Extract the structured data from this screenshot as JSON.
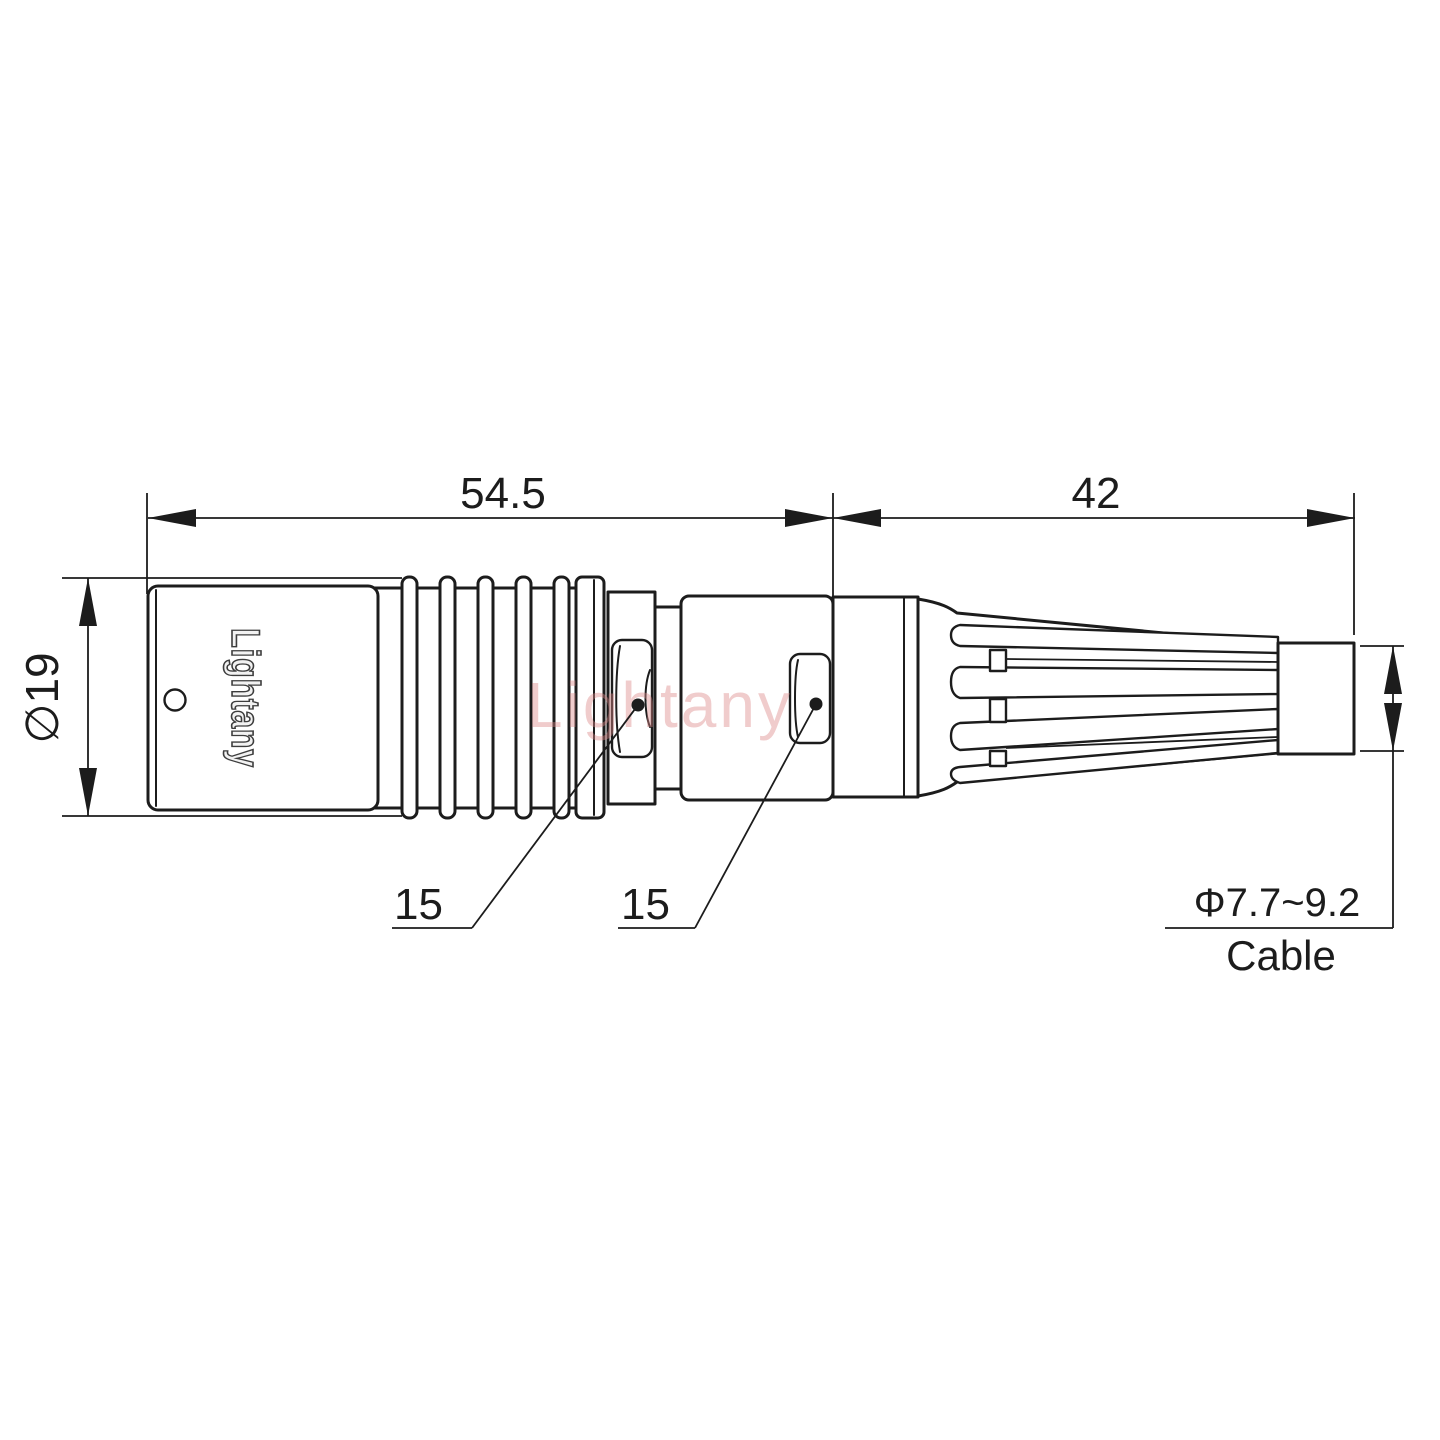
{
  "drawing": {
    "watermark": "Lightany",
    "connector": {
      "body_marking": "Lightany"
    },
    "dimensions": {
      "front_length": "54.5",
      "rear_length": "42",
      "body_diameter": "∅19",
      "front_flat": "15",
      "rear_flat": "15"
    },
    "cable": {
      "diameter_range": "Φ7.7~9.2",
      "label": "Cable"
    },
    "colors": {
      "line": "#1c1c1c",
      "marking": "#3d3d3d",
      "watermark": "#dd8888",
      "background": "#ffffff"
    }
  }
}
